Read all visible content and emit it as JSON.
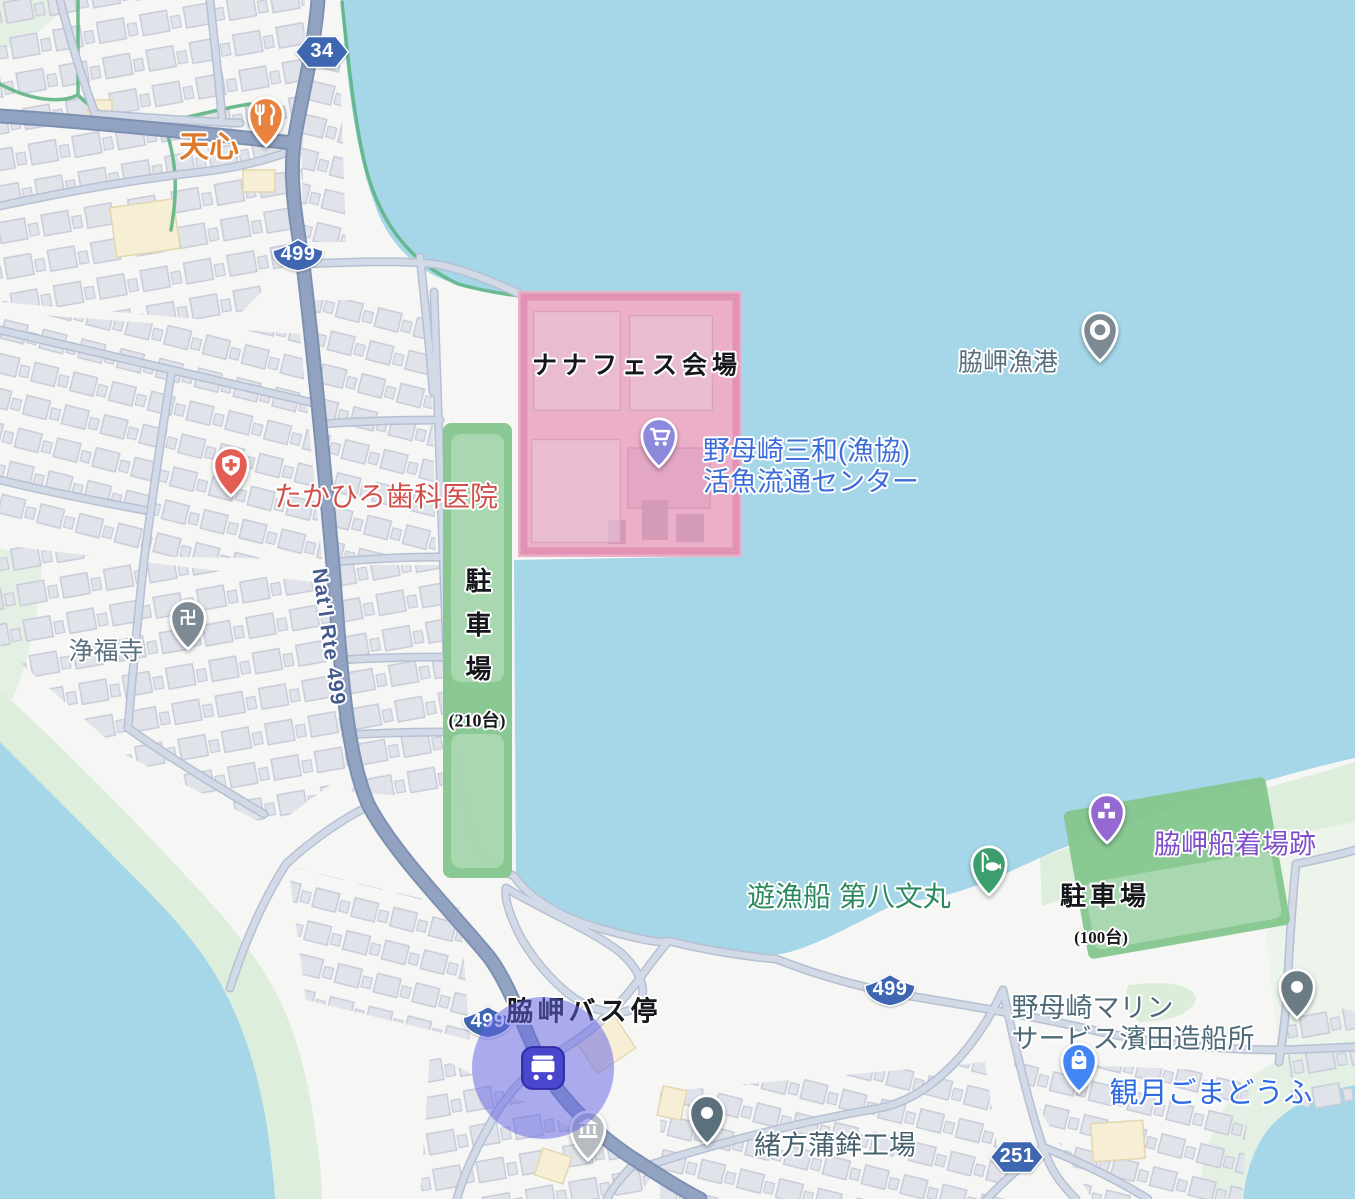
{
  "map_title": "脇岬港周辺マップ（ナナフェス会場案内）",
  "colors": {
    "water": "#a5d7e8",
    "land": "#f6f7f5",
    "shore_green": "#ddeedd",
    "building": "#e1e3ea",
    "road_major": "#92a3c2",
    "road_minor": "#d3dae7",
    "route_shield_blue": "#3f66b0",
    "trail_green": "#5fb585",
    "festival_overlay_pink": "#e9558f",
    "parking_overlay_green": "#84c68d",
    "bus_highlight_purple": "#6463e4"
  },
  "areas": {
    "festival_venue": {
      "label": "ナナフェス会場"
    },
    "parking_left": {
      "label": "駐車場",
      "capacity": "(210台)"
    },
    "parking_right": {
      "label": "駐車場",
      "capacity": "(100台)"
    },
    "bus_stop": {
      "label": "脇岬バス停"
    }
  },
  "road_label": {
    "text": "Nat'l Rte 499"
  },
  "shields": [
    {
      "name": "route-shield-34",
      "shape": "hex",
      "text": "34",
      "x": 322,
      "y": 52
    },
    {
      "name": "route-shield-499-top",
      "shape": "kite",
      "text": "499",
      "x": 298,
      "y": 255
    },
    {
      "name": "route-shield-499-bus",
      "shape": "kite",
      "text": "499",
      "x": 488,
      "y": 1022
    },
    {
      "name": "route-shield-499-bay",
      "shape": "kite",
      "text": "499",
      "x": 890,
      "y": 990
    },
    {
      "name": "route-shield-251",
      "shape": "hex",
      "text": "251",
      "x": 1017,
      "y": 1157
    }
  ],
  "markers": [
    {
      "name": "restaurant-tenshin",
      "icon": "restaurant-icon",
      "pin_color": "#e8823c",
      "x": 266,
      "y": 146,
      "label": {
        "text": "天心",
        "color": "#dd7a2c",
        "size": 30,
        "weight": 700,
        "dx": -57,
        "dy": 2
      }
    },
    {
      "name": "wakimisaki-fishing-port",
      "icon": "harbor-icon",
      "pin_color": "#7d8a93",
      "x": 1100,
      "y": 361,
      "label": {
        "text": "脇岬漁港",
        "color": "#5a7080",
        "size": 25,
        "weight": 500,
        "dx": -92,
        "dy": 2
      }
    },
    {
      "name": "fish-distribution-center",
      "icon": "cart-icon",
      "pin_color": "#8d89dd",
      "x": 659,
      "y": 467,
      "label": {
        "lines": [
          "野母崎三和(漁協)",
          "活魚流通センター"
        ],
        "color": "#3d6cd8",
        "size": 27,
        "weight": 500,
        "dx": 152,
        "dy": 0
      }
    },
    {
      "name": "takahiro-dental-clinic",
      "icon": "dental-icon",
      "pin_color": "#e35d55",
      "x": 231,
      "y": 496,
      "label": {
        "text": "たかひろ歯科医院",
        "color": "#d2504b",
        "size": 28,
        "weight": 500,
        "dx": 155,
        "dy": 1
      }
    },
    {
      "name": "jofukuji-temple",
      "icon": "temple-icon",
      "pin_color": "#7d8a93",
      "x": 188,
      "y": 649,
      "label": {
        "text": "浄福寺",
        "color": "#5a7080",
        "size": 25,
        "weight": 500,
        "dx": -82,
        "dy": 3
      }
    },
    {
      "name": "wakimisaki-boat-landing-ruins",
      "icon": "historic-icon",
      "pin_color": "#9668d2",
      "x": 1107,
      "y": 843,
      "label": {
        "text": "脇岬船着場跡",
        "color": "#7e4fc8",
        "size": 27,
        "weight": 500,
        "dx": 128,
        "dy": 2
      }
    },
    {
      "name": "fishing-boat-daihachi-fumimaru",
      "icon": "fishing-icon",
      "pin_color": "#3d9e6d",
      "x": 989,
      "y": 895,
      "label": {
        "text": "遊漁船 第八文丸",
        "color": "#2c8a5e",
        "size": 28,
        "weight": 500,
        "dx": -140,
        "dy": 2
      }
    },
    {
      "name": "nomozaki-marine-service-shipyard",
      "icon": "dot-icon",
      "pin_color": "#6a7b84",
      "x": 1297,
      "y": 1018,
      "label": {
        "lines": [
          "野母崎マリン",
          "サービス濱田造船所"
        ],
        "color": "#4e6a78",
        "size": 27,
        "weight": 500,
        "dx": -164,
        "dy": 6
      }
    },
    {
      "name": "kangetsu-gomadofu",
      "icon": "bag-icon",
      "pin_color": "#4285f4",
      "x": 1079,
      "y": 1092,
      "label": {
        "text": "観月ごまどうふ",
        "color": "#2e6be0",
        "size": 29,
        "weight": 500,
        "dx": 132,
        "dy": 2
      }
    },
    {
      "name": "ogata-kamaboko-factory",
      "icon": "dot-icon",
      "pin_color": "#5c707c",
      "x": 707,
      "y": 1144,
      "label": {
        "text": "緒方蒲鉾工場",
        "color": "#46606e",
        "size": 27,
        "weight": 500,
        "dx": 128,
        "dy": 2
      }
    },
    {
      "name": "museum-poi",
      "icon": "museum-icon",
      "pin_color": "#b7bcc1",
      "x": 588,
      "y": 1160,
      "label": null
    }
  ],
  "annotations": [
    {
      "name": "festival-venue-label",
      "bind": "areas.festival_venue.label",
      "x": 637,
      "y": 367,
      "size": 25,
      "spacing": 5
    },
    {
      "name": "parking-left-label",
      "bind": "areas.parking_left.label",
      "x": 476,
      "y": 633,
      "size": 26,
      "vertical": true,
      "spacing": 18
    },
    {
      "name": "parking-left-capacity",
      "bind": "areas.parking_left.capacity",
      "x": 477,
      "y": 721,
      "size": 18
    },
    {
      "name": "parking-right-label",
      "bind": "areas.parking_right.label",
      "x": 1105,
      "y": 897,
      "size": 26,
      "spacing": 4
    },
    {
      "name": "parking-right-capacity",
      "bind": "areas.parking_right.capacity",
      "x": 1101,
      "y": 938,
      "size": 17
    },
    {
      "name": "bus-stop-label",
      "bind": "areas.bus_stop.label",
      "x": 584,
      "y": 1012,
      "size": 27,
      "spacing": 4
    }
  ],
  "bus_stop_marker": {
    "name": "bus-stop",
    "x": 543,
    "y": 1068
  }
}
